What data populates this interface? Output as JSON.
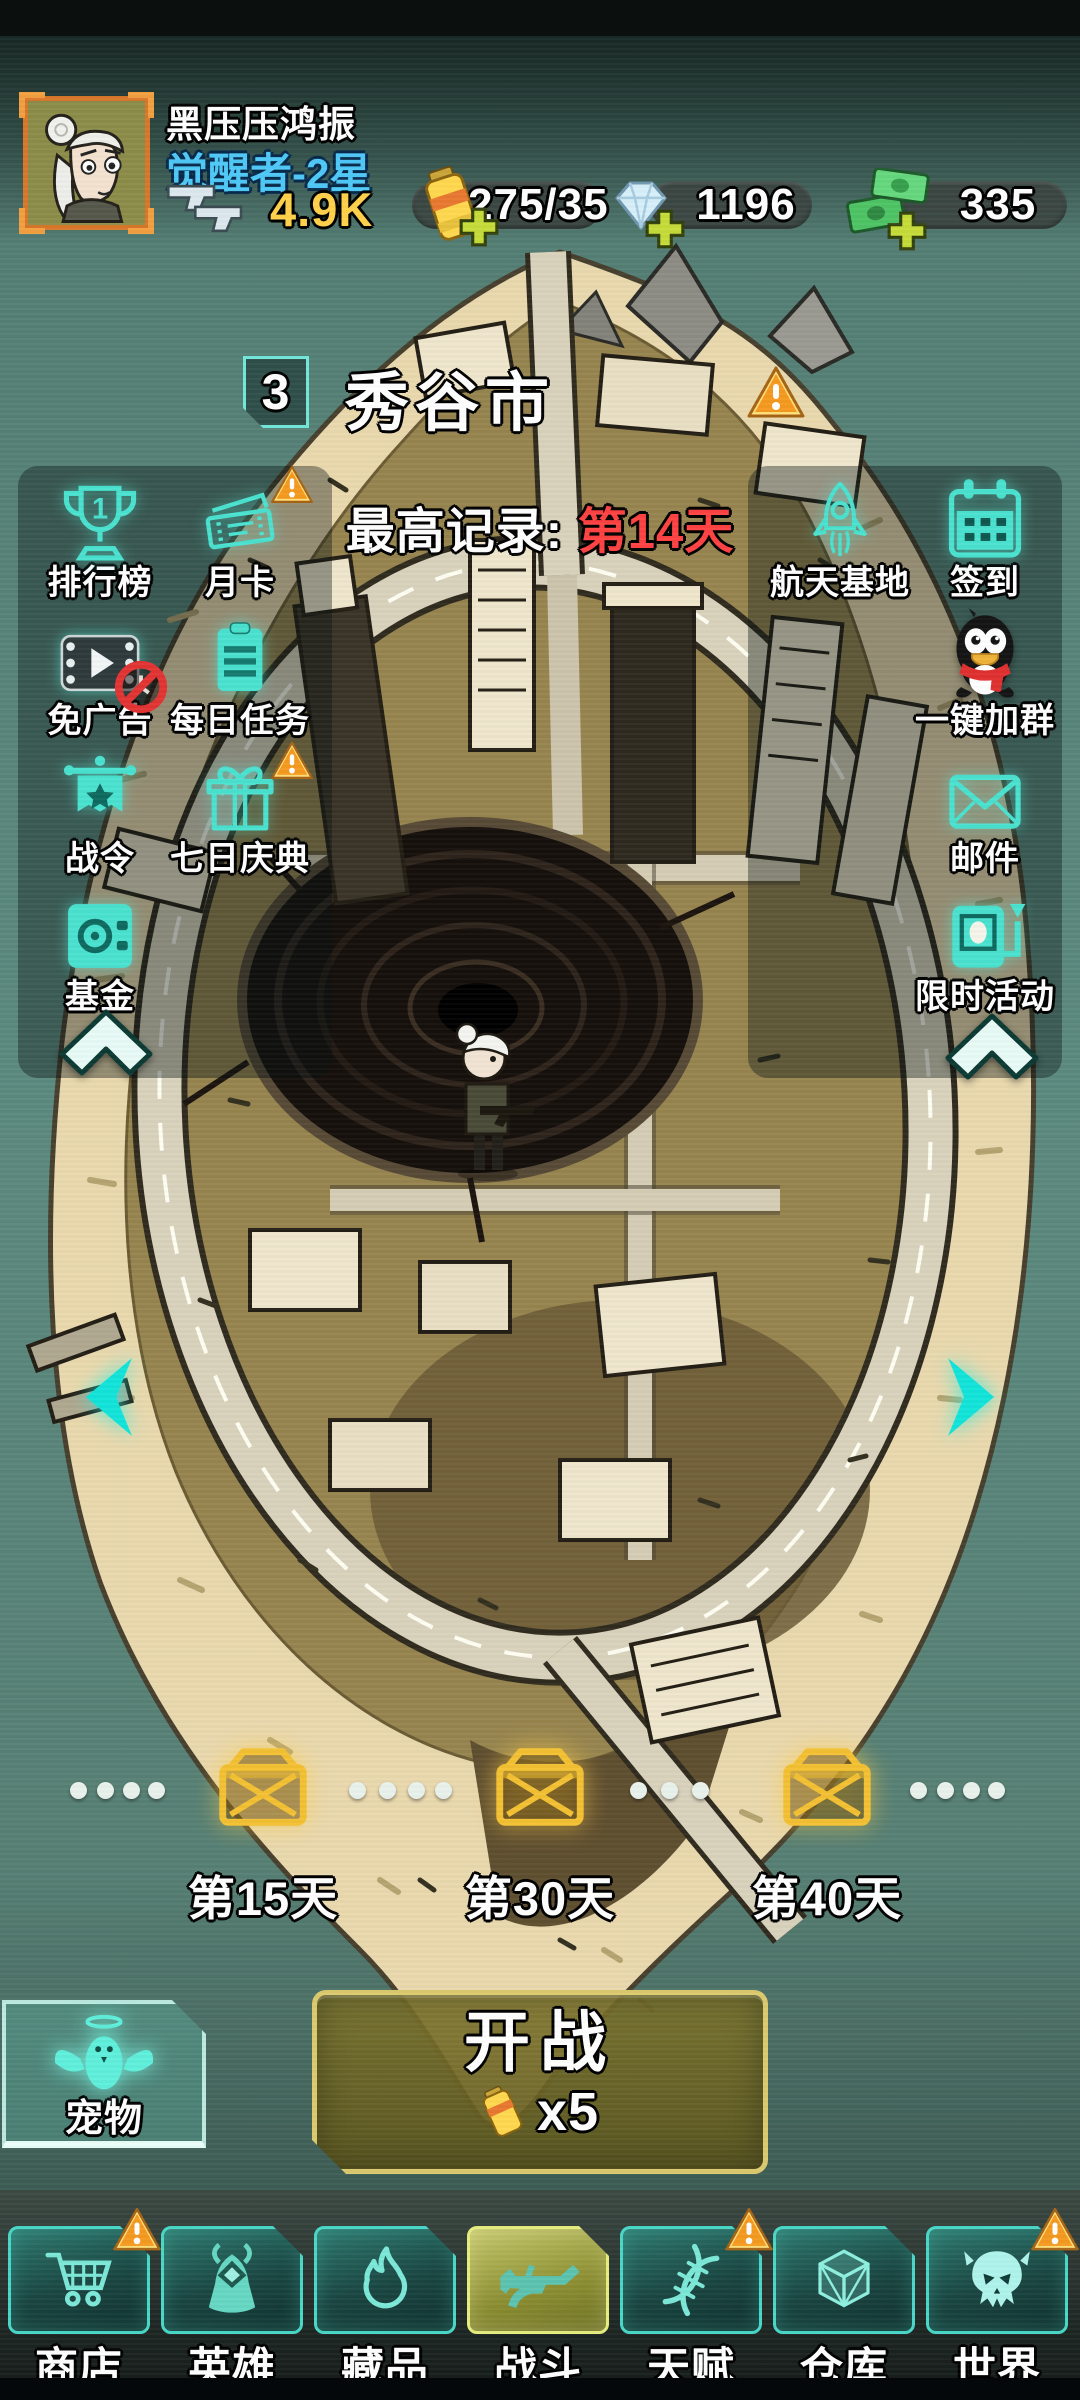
{
  "colors": {
    "accent_cyan": "#4ae2d0",
    "level_blue": "#4fc9f7",
    "ammo_yellow": "#ffd24a",
    "record_red": "#ff4242",
    "warning_orange": "#f59a20",
    "chest_gold": "#f4c133",
    "battle_olive": "#6e6726",
    "nav_active_olive": "#b8bd5c",
    "water_teal": "#5c8a7f"
  },
  "player": {
    "name": "黑压压鸿振",
    "level": "觉醒者-2星"
  },
  "currencies": {
    "ammo": {
      "icon": "dual-pistols-icon",
      "value": "4.9K"
    },
    "energy": {
      "icon": "battery-icon",
      "value": "275/35"
    },
    "diamonds": {
      "icon": "diamond-icon",
      "value": "1196"
    },
    "cash": {
      "icon": "money-icon",
      "value": "335"
    }
  },
  "stage": {
    "badge": "3",
    "title": "秀谷市",
    "record_label": "最高记录: ",
    "record_value": "第14天",
    "has_warning": true
  },
  "left_menu": [
    {
      "label": "排行榜",
      "icon": "trophy-icon",
      "rank": "1"
    },
    {
      "label": "月卡",
      "icon": "ticket-icon",
      "warning": true
    },
    {
      "label": "免广告",
      "icon": "video-ad-icon",
      "badge": "no-ads"
    },
    {
      "label": "每日任务",
      "icon": "daily-tasks-icon"
    },
    {
      "label": "战令",
      "icon": "battle-pass-flag-icon"
    },
    {
      "label": "七日庆典",
      "icon": "gift-icon",
      "warning": true
    },
    {
      "label": "基金",
      "icon": "safe-icon"
    }
  ],
  "right_menu": [
    {
      "label": "航天基地",
      "icon": "rocket-icon"
    },
    {
      "label": "签到",
      "icon": "calendar-icon"
    },
    {
      "label": "一键加群",
      "icon": "qq-penguin-icon"
    },
    {
      "label": "邮件",
      "icon": "mail-icon"
    },
    {
      "label": "限时活动",
      "icon": "timed-event-icon"
    }
  ],
  "milestones": [
    {
      "day": "第15天",
      "icon": "gold-chest-icon"
    },
    {
      "day": "第30天",
      "icon": "gold-chest-icon"
    },
    {
      "day": "第40天",
      "icon": "gold-chest-icon"
    }
  ],
  "pet": {
    "label": "宠物",
    "icon": "angel-pet-icon"
  },
  "battle": {
    "label": "开战",
    "cost_multiplier": "x5",
    "cost_icon": "battery-icon"
  },
  "nav": [
    {
      "label": "商店",
      "icon": "cart-icon",
      "warning": true
    },
    {
      "label": "英雄",
      "icon": "hero-icon"
    },
    {
      "label": "藏品",
      "icon": "flame-icon"
    },
    {
      "label": "战斗",
      "icon": "rifle-icon",
      "active": true
    },
    {
      "label": "天赋",
      "icon": "dna-icon",
      "warning": true
    },
    {
      "label": "仓库",
      "icon": "crate-icon"
    },
    {
      "label": "世界",
      "icon": "skull-icon",
      "warning": true
    }
  ]
}
